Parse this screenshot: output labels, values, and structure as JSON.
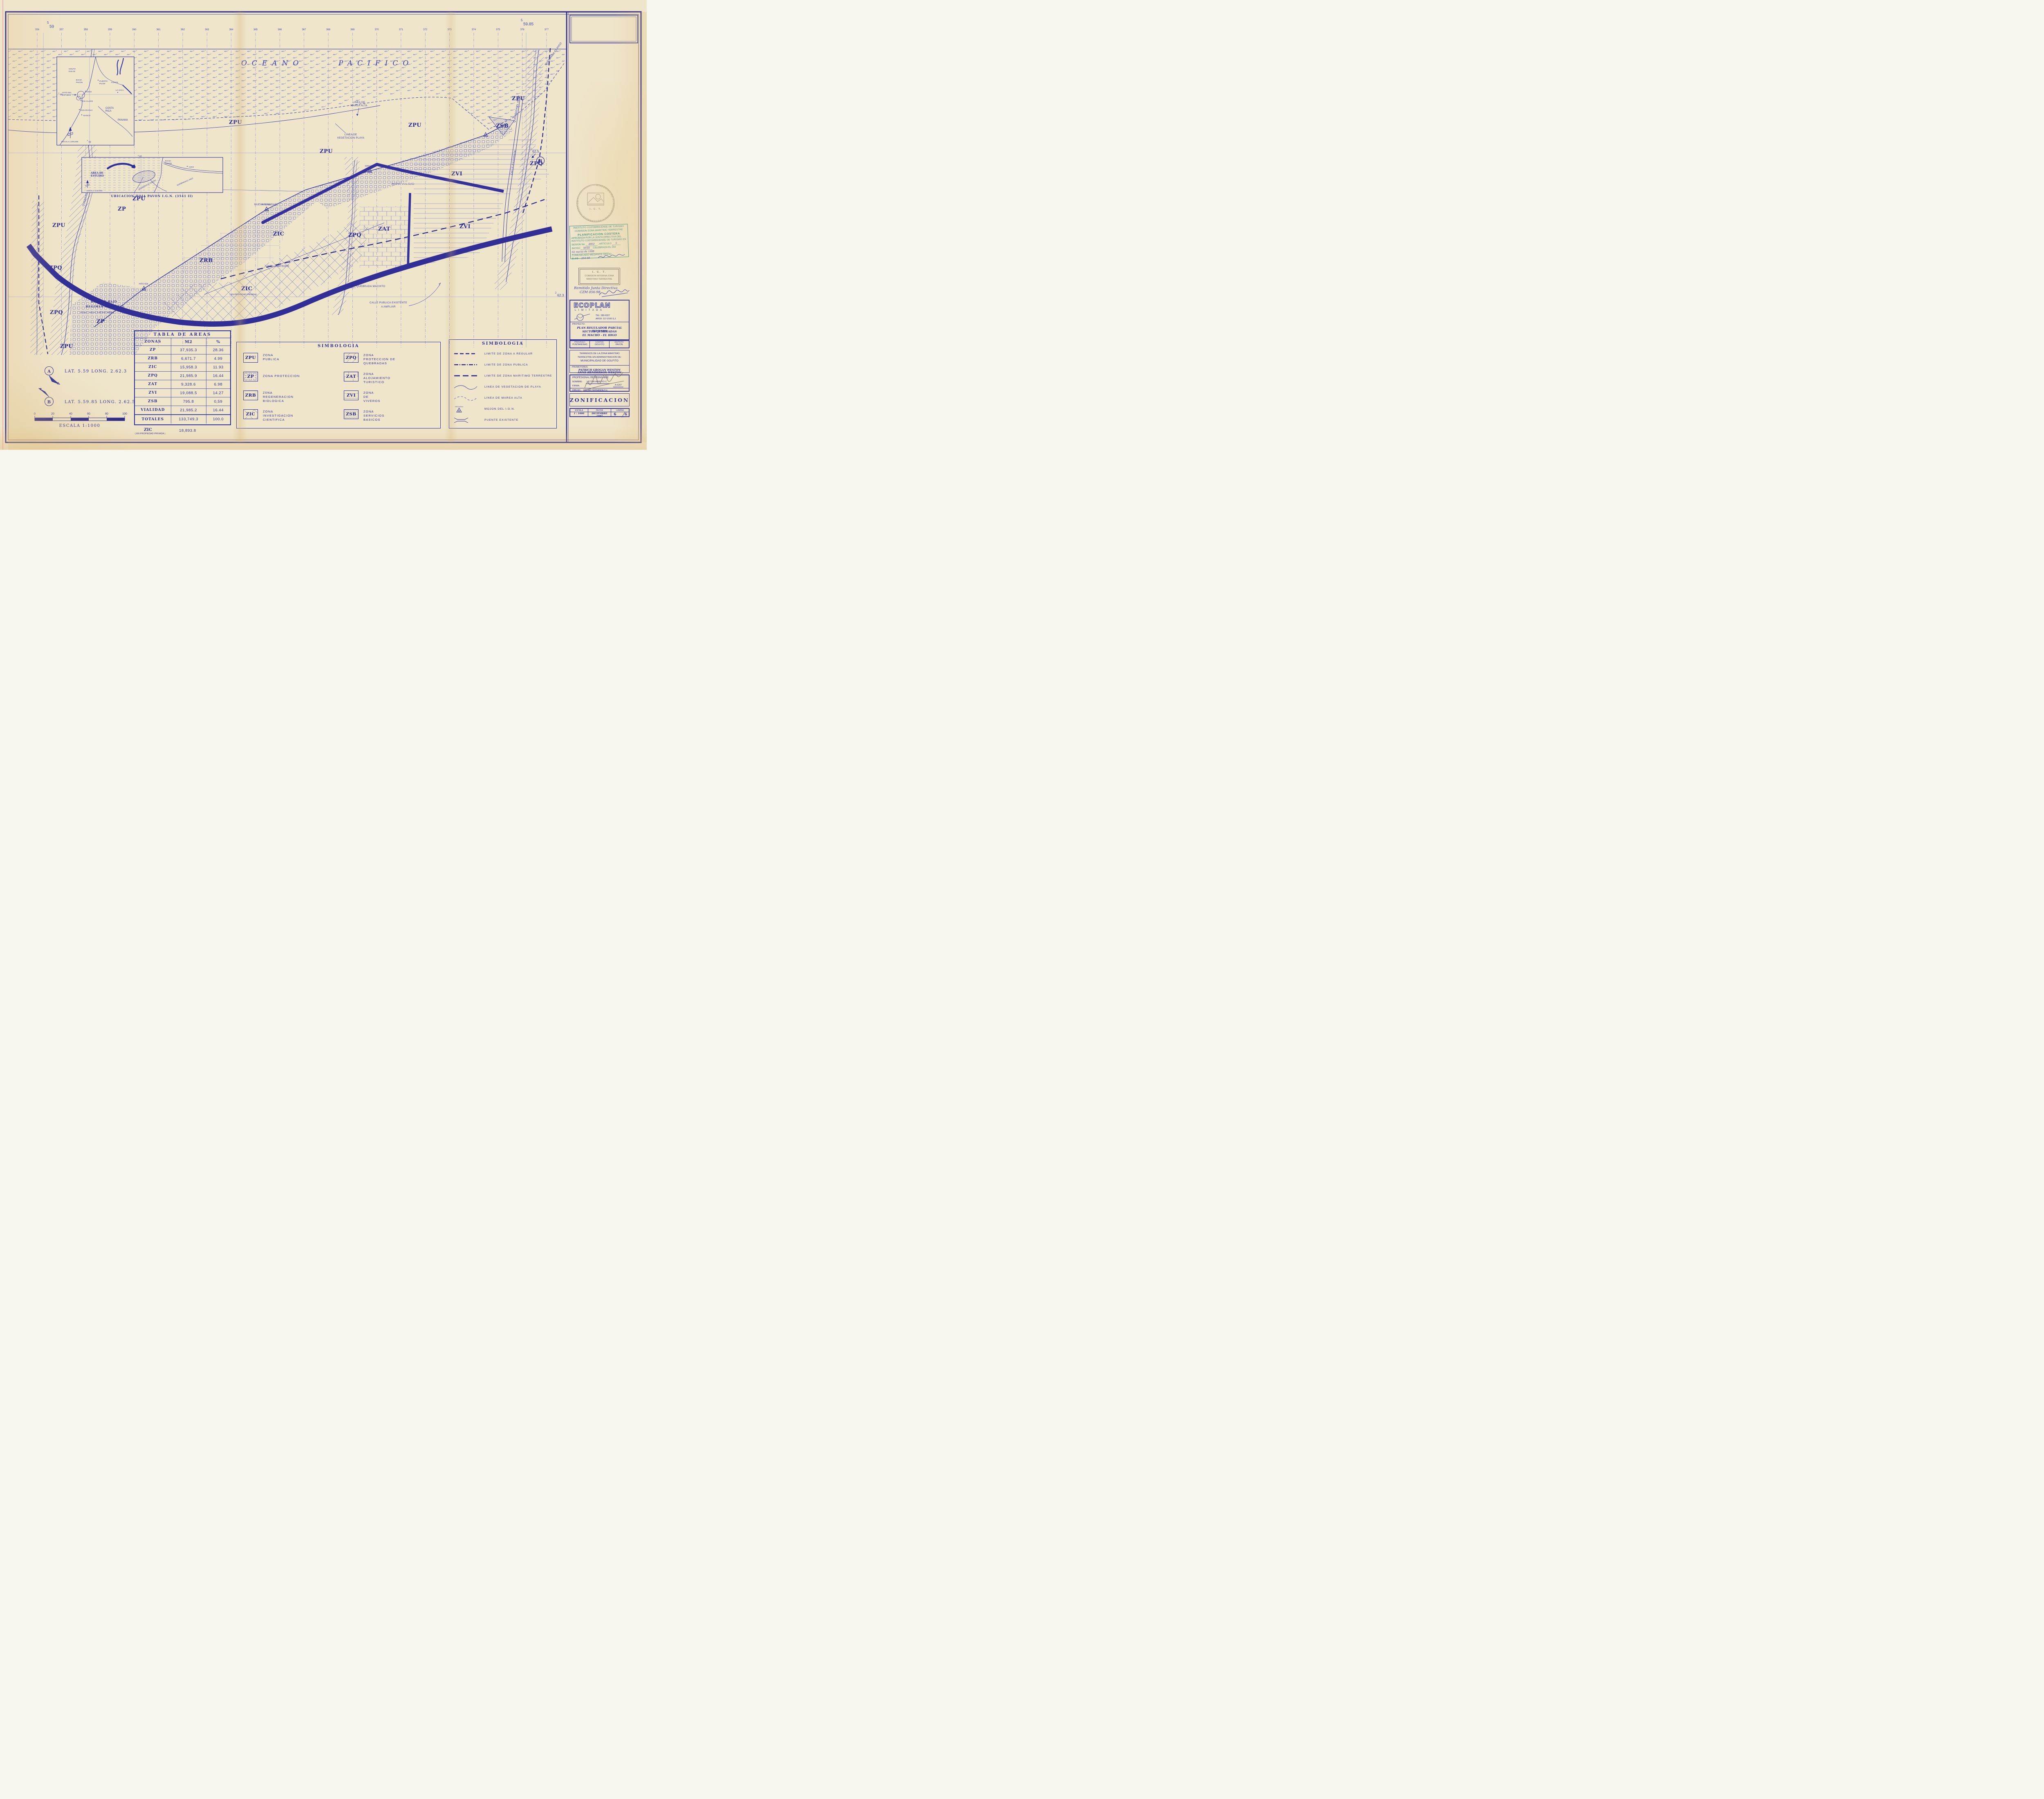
{
  "colors": {
    "ink": "#2c2f9b",
    "ink_dark": "#2a2888",
    "road": "#312f96",
    "pattern": "#646abd",
    "stamp_teal": "#3a8d82",
    "hand_blue": "#3c43ad",
    "pencil": "#6e6554",
    "paper": "#efe5cb"
  },
  "grid": {
    "numbers": [
      "356",
      "357",
      "358",
      "359",
      "360",
      "361",
      "362",
      "363",
      "364",
      "365",
      "366",
      "367",
      "368",
      "369",
      "370",
      "371",
      "372",
      "373",
      "374",
      "375",
      "376",
      "377"
    ],
    "lat_left": {
      "sup": "5",
      "val": "59"
    },
    "lat_right": {
      "sup": "5",
      "val": "59.85"
    },
    "y_upper": {
      "sup": "2",
      "val": "62.5"
    },
    "y_lower": {
      "sup": "2",
      "val": "62.3"
    }
  },
  "ocean": [
    "OCEANO",
    "PACIFICO"
  ],
  "codes": {
    "zpu": "ZPU",
    "zp": "ZP",
    "zrb": "ZRB",
    "zic": "ZIC",
    "zpq": "ZPQ",
    "zat": "ZAT",
    "zvi": "ZVI",
    "zsb": "ZSB"
  },
  "ann": {
    "marea": [
      "LINEA DE",
      "MAREA ALTA"
    ],
    "veg": [
      "LINEA DE",
      "VEGETACION PLAYA"
    ],
    "lim_zpu": [
      "LIMITE DE",
      "ZONA PUBLICA"
    ],
    "nueva_vialidad": "NUEVA VIALIDAD",
    "calle_existente": "CALLE EXISTENTE",
    "calle_publica": [
      "CALLE PUBLICA EXISTENTE",
      "A AMPLIAR"
    ],
    "linea_limitrofe": "LINEA LIMITROFE",
    "q_macho": "QUEBRADA EL MACHO",
    "q_machito": "QUEBRADA MACHITO",
    "q_higo": "QUEBRADA EL HIGO",
    "hito": "HITO IGN",
    "bosque": [
      "BOSQUE BAJO",
      "REGIMEN FORESTAL",
      "(Tomo 7, Folio 47, A.89 DGF, MINAE)"
    ],
    "zic_priv": "( EN PROPIEDAD PRIVADA )"
  },
  "inset1": {
    "escala": "ESCALA 1:200,000",
    "golfo": [
      "GOLFO",
      "DULCE"
    ],
    "bahia": [
      "BAHIA",
      "PAVON"
    ],
    "puerto": [
      "PUERTO",
      "PILON"
    ],
    "conte": "CONTE",
    "lavaca": "LA VACA",
    "sitio": [
      "SITIO DEL",
      "ESTUDIO"
    ],
    "higo": "HIGO",
    "rioclaro": "RIO CLARO",
    "nicaragua": "NICARAGUA",
    "banco": "BANCO",
    "costarica": [
      "COSTA",
      "RICA"
    ],
    "panama": "PANAMA",
    "ref_y": {
      "sup": "2",
      "val": "60"
    },
    "ref_x": {
      "sup": "5",
      "val": "60"
    }
  },
  "inset2": {
    "escala": "ESCALA 1:50.000",
    "caption": "UBICACION HOJA PAVON I.G.N. (3541 II)",
    "bahia": [
      "BAHIA",
      "PAVON"
    ],
    "area": [
      "AREA DE",
      "ESTUDIO"
    ],
    "higo": "HIGO",
    "q_macho": "QUEBRADA EL MACHO",
    "q_higo": "QUEBRADA EL HIGO",
    "ref_x": {
      "sup": "5",
      "val": "60"
    }
  },
  "notes": {
    "a_letter": "A",
    "a_text": "LAT.  5.59    LONG.  2.62.3",
    "b_letter": "B",
    "b_text": "LAT.  5.59.85    LONG.  2.62.5"
  },
  "scalebar": {
    "ticks": [
      "0",
      "20",
      "40",
      "60",
      "80",
      "100"
    ],
    "label": "ESCALA  1:1000"
  },
  "tabla": {
    "title": "TABLA DE AREAS",
    "headers": [
      "ZONAS",
      "M2",
      "%"
    ],
    "rows": [
      [
        "ZP",
        "37,935.3",
        "28.36"
      ],
      [
        "ZRB",
        "6,671.7",
        "4.99"
      ],
      [
        "ZIC",
        "15,958.3",
        "11.93"
      ],
      [
        "ZPQ",
        "21,985.9",
        "16.44"
      ],
      [
        "ZAT",
        "9,328.6",
        "6.98"
      ],
      [
        "ZVI",
        "19,088.5",
        "14.27"
      ],
      [
        "ZSB",
        "795.8",
        "0,59"
      ],
      [
        "VIALIDAD",
        "21,985.2",
        "16.44"
      ]
    ],
    "totales": [
      "TOTALES",
      "133,749.3",
      "100.0"
    ],
    "extra": {
      "zona": "ZIC",
      "nota": "( EN PROPIEDAD PRIVADA )",
      "m2": "18,893.8"
    }
  },
  "leg_zonas": {
    "title": "SIMBOLOGIA",
    "items": [
      {
        "code": "ZPU",
        "lines": [
          "ZONA",
          "PUBLICA"
        ]
      },
      {
        "code": "ZP",
        "lines": [
          "ZONA  PROTECCION"
        ]
      },
      {
        "code": "ZRB",
        "lines": [
          "Z0NA",
          "REGENERACION",
          "BIOLOGICA"
        ]
      },
      {
        "code": "ZIC",
        "lines": [
          "ZONA",
          "INVESTIGACION",
          "CIENTIFICA"
        ]
      },
      {
        "code": "ZPQ",
        "lines": [
          "ZONA",
          "PROTECCION  DE",
          "QUEBRADAS"
        ]
      },
      {
        "code": "ZAT",
        "lines": [
          "ZONA",
          "ALOJAMIENTO",
          "TURISTICO"
        ]
      },
      {
        "code": "ZVI",
        "lines": [
          "ZONA",
          "DE",
          "VIVEROS"
        ]
      },
      {
        "code": "ZSB",
        "lines": [
          "ZONA",
          "SERVICIOS",
          "BASICOS"
        ]
      }
    ]
  },
  "leg_lineas": {
    "title": "SIMBOLOGIA",
    "hito": "HITO IGN #",
    "items": [
      "LIMITE DE ZONA A REGULAR",
      "LIMITE DE ZONA PUBLICA",
      "LIMITE DE ZONA MARITIMO TERRESTRE",
      "LINEA DE VEGETACION DE PLAYA",
      "LINEA DE MAREA ALTA",
      "MOJON DEL I.G.N.",
      "PUENTE EXISTENTE"
    ]
  },
  "stamps": {
    "apr": {
      "l1": "INSTITUTO COSTARRICENSE DE TURISMO",
      "l2": "COMISION ZONA MARITIMO TERRESTRE",
      "l3": "PLANIFICACION COSTERA",
      "l4": "APROBADA POR LA JUNTA DIRECTIVA DEL",
      "l5": "INSTITUTO COSTARRICENSE DE TURISMO EN",
      "sesion": "SESION No.",
      "sesion_v": "4802",
      "articulo": ", ARTICULO",
      "articulo_v": "5",
      "inciso": "INCISO",
      "inciso_v": "XVIII",
      "celebrada": "CELEBRADA EL DIA",
      "fecha_v": "02 marzo de 1998",
      "l9": "COMUNICADO MEDIANTE OFICIO",
      "sjd": "S J D-",
      "sjd_v": "254-98"
    },
    "ict": {
      "l1": "I. C. T.",
      "l2": "COMISION INTERNA ZONA",
      "l3": "MARITIMO TERRESTRE",
      "hand1": "Remitido Junta Directiva",
      "hand2": "CZM 056-98"
    },
    "seal": {
      "ring": "DIRECCION DE PLANEAMIENTO Y DESARROLLO TURISTICO  *",
      "ict": "I. C. T."
    }
  },
  "tb": {
    "empresa": "ECOPLAN",
    "tipo": "L I M I T A D A",
    "tel": "TEL:  280-9327",
    "apdo": "APDO:  117-2100  S.J.",
    "proy_label": "PROYECTO:",
    "proy": [
      "PLAN REGULADOR PARCIAL PAVONES",
      "SECTOR QUEBRADAS",
      "EL MACHO - EL HIGO"
    ],
    "ub_h": [
      "PROVINCIA",
      "CANTON",
      "DISTRITO"
    ],
    "ub_v": [
      "PUNTARENAS",
      "GOLFITO",
      "PAVON"
    ],
    "terrenos": [
      "TERRENOS DE LA ZONA MARITIMO",
      "TERRESTRE EN ADMINISTRACION DE:",
      "MUNICIPALIDAD DE GOLFITO"
    ],
    "prom_label": "PROMOTORES:",
    "prom": [
      "PATRICH GROGAN WESTON",
      "ANNE HENDERSON WESTON"
    ],
    "prof_title": "PROFESIONAL RESPONSABLE",
    "nombre_l": "NOMBRE:",
    "nombre": "VICTOR ARROYO C.",
    "firma_l": "FIRMA:",
    "codigo": "A-6267",
    "dibujo_l": "DIBUJO:",
    "dibujo": "OSCAR FERNANDEZ H.",
    "zonif": "ZONIFICACION",
    "f_h": [
      "ESCALA",
      "FECHA",
      "LAMINA"
    ],
    "f_escala": "1 : 1000",
    "f_fecha": "DICIEMBRE 1997",
    "f_lam_n": "6",
    "f_lam_t": "6"
  }
}
